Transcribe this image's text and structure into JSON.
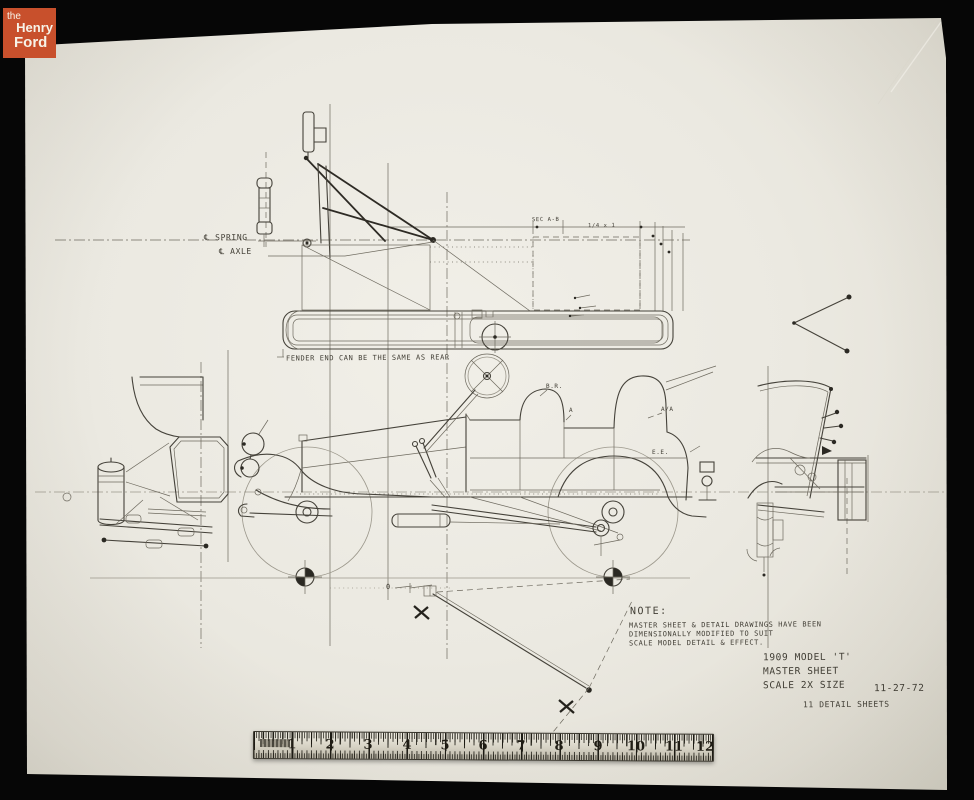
{
  "logo": {
    "the": "the",
    "henry": "Henry",
    "ford": "Ford"
  },
  "drawing": {
    "annotations": {
      "centerline_spring": "℄ SPRING",
      "centerline_axle": "℄ AXLE",
      "fender_note": "FENDER END CAN BE THE SAME AS REAR",
      "section_note": "SEC A-B",
      "dim_note": "1/4 x 1",
      "label_br": "B.R.",
      "label_a": "A",
      "label_aa": "A/A",
      "label_ee": "E.E.",
      "datum_zero": "0"
    },
    "note": {
      "heading": "NOTE:",
      "line1": "MASTER SHEET & DETAIL DRAWINGS HAVE BEEN",
      "line2": "DIMENSIONALLY MODIFIED TO SUIT",
      "line3": "SCALE MODEL DETAIL & EFFECT."
    },
    "title_block": {
      "line1": "1909 MODEL 'T'",
      "line2": "MASTER SHEET",
      "line3": "SCALE 2X SIZE",
      "date": "11-27-72",
      "sheets": "11 DETAIL SHEETS"
    }
  },
  "ruler": {
    "numbers": [
      "1",
      "2",
      "3",
      "4",
      "5",
      "6",
      "7",
      "8",
      "9",
      "10",
      "11",
      "12"
    ]
  },
  "colors": {
    "logo_red": "#c8502c",
    "paper": "#ebe9e1",
    "ink": "#45423a",
    "background": "#060606"
  }
}
